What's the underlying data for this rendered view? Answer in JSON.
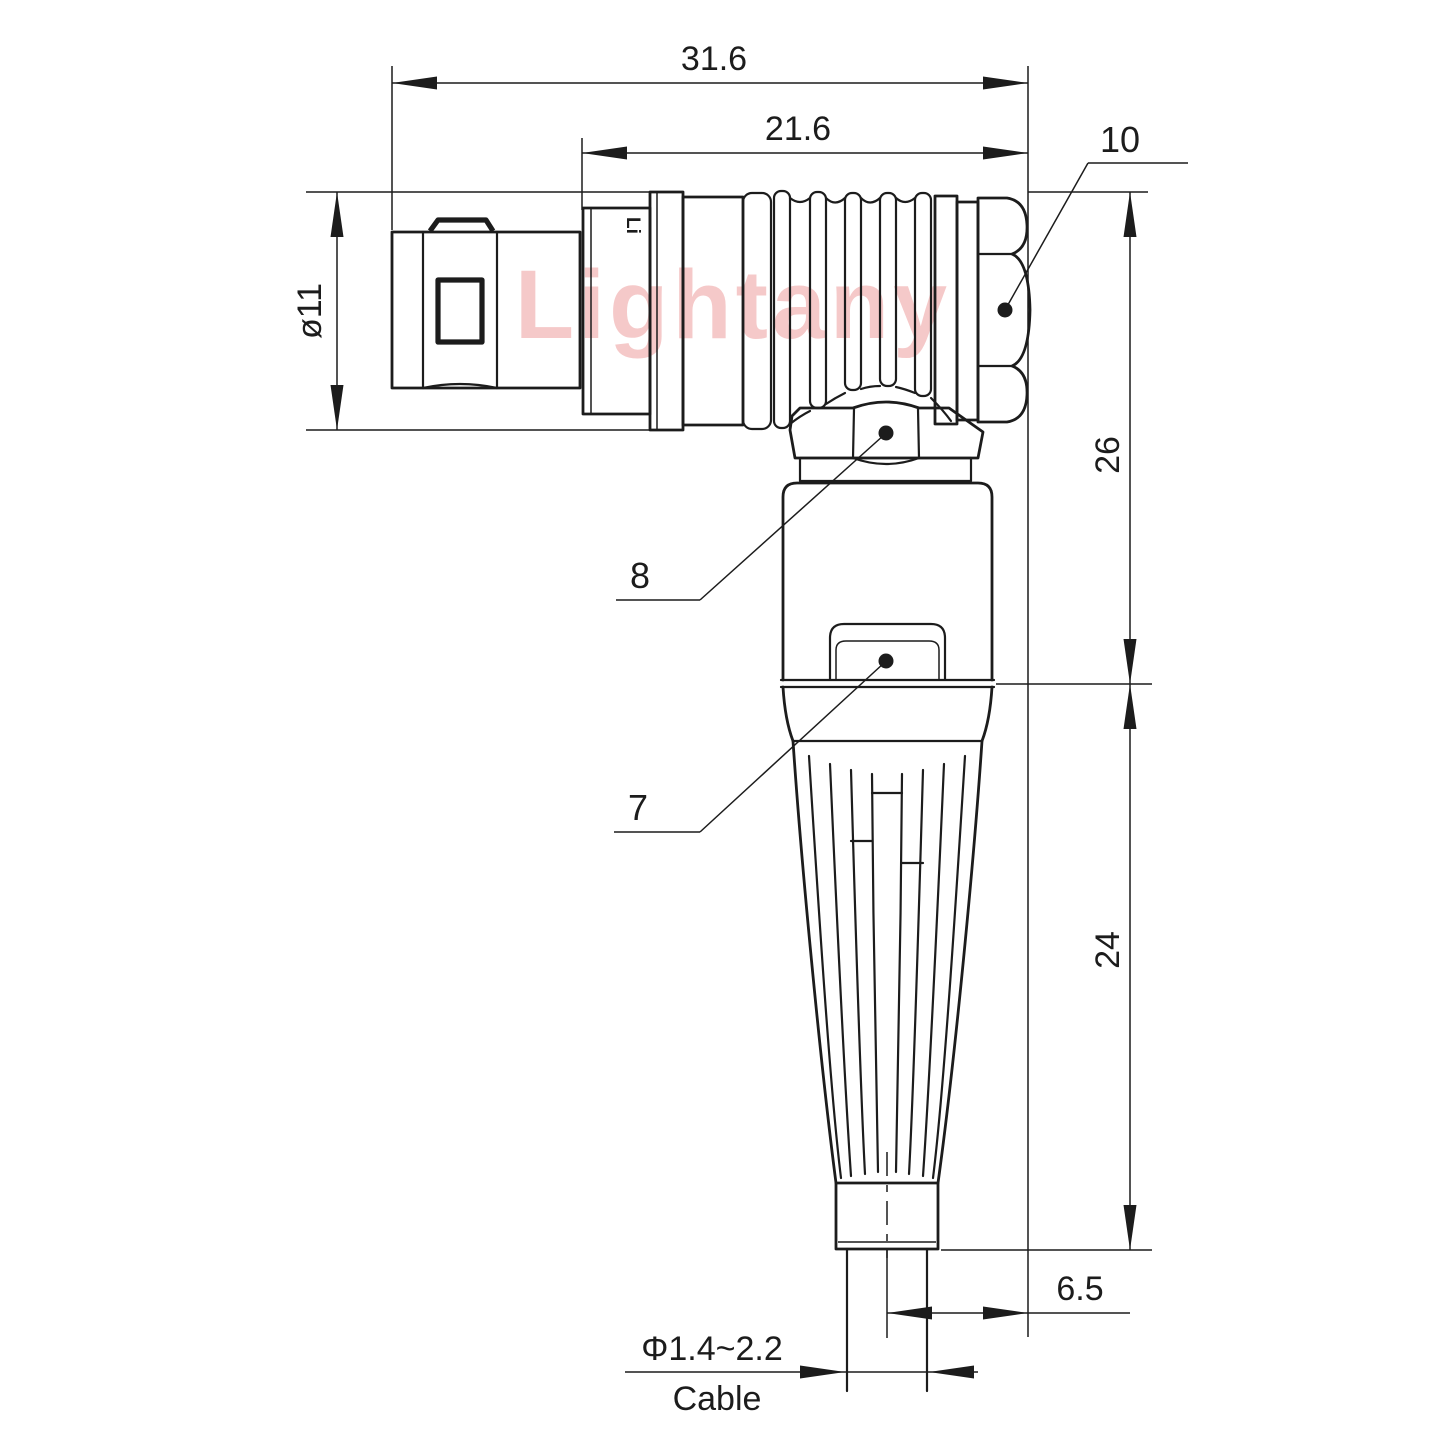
{
  "drawing": {
    "watermark": "Lightany",
    "connector_mark": "Li",
    "dimensions": {
      "overall_length": "31.6",
      "rear_length": "21.6",
      "barrel_diameter": "ø11",
      "height_upper": "26",
      "height_lower": "24",
      "cable_offset": "6.5",
      "cable_diameter_range": "Φ1.4~2.2",
      "cable_label": "Cable"
    },
    "callouts": [
      {
        "number": "10",
        "target": "rear-hex-nut"
      },
      {
        "number": "8",
        "target": "elbow-hex-nut"
      },
      {
        "number": "7",
        "target": "body-latch-clip"
      }
    ],
    "colors": {
      "line_color": "#1c1c1c",
      "watermark_color": "#f3bcbc",
      "background": "#ffffff"
    }
  }
}
